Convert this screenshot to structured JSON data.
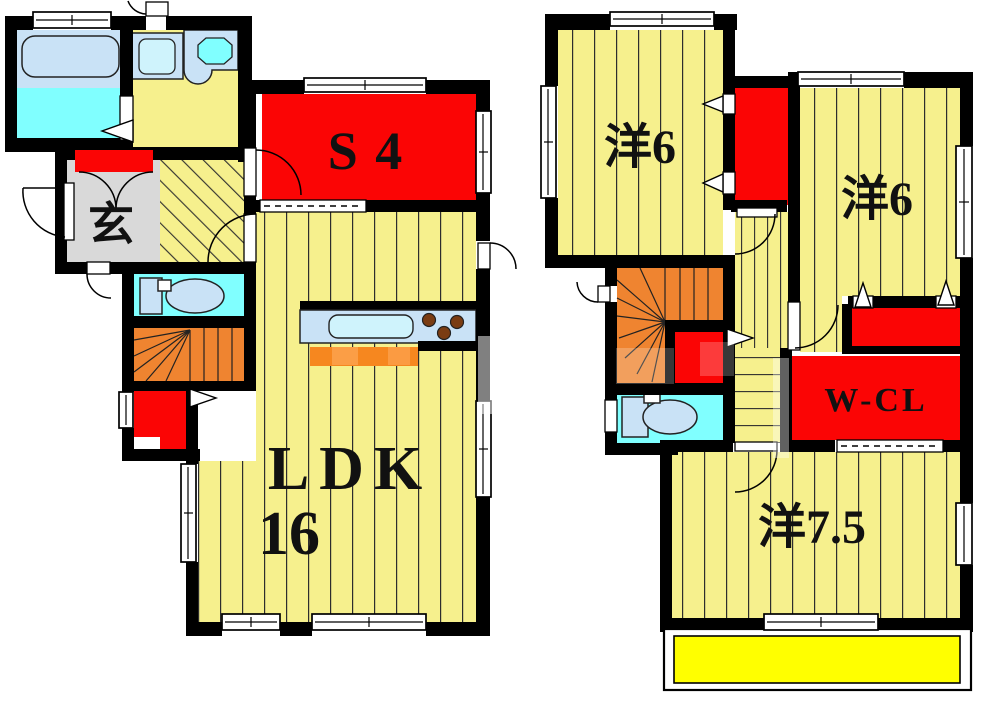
{
  "document": {
    "type": "floor-plan",
    "floors": 2
  },
  "colors": {
    "wall": "#000000",
    "floor_yellow": "#F6F08D",
    "accent_red": "#FB0505",
    "stairs_orange": "#EF8430",
    "cabinet_orange": "#F6871F",
    "fixture_cyan": "#80FFFF",
    "entry_gray": "#D9D9D9",
    "fixture_blue": "#C9E2F6",
    "sink_blue": "#CFF3FC",
    "burner_brown": "#7A3C12",
    "balcony_yellow": "#FFFF00",
    "label_ink": "#111111"
  },
  "floor1": {
    "entrance_label": "玄",
    "service_room_label": "S 4",
    "ldk_label": "LDK",
    "ldk_size_label": "16"
  },
  "floor2": {
    "bedroom_left_label": "洋6",
    "bedroom_right_label": "洋6",
    "walkin_closet_label": "W-CL",
    "bedroom_large_label": "洋7.5"
  }
}
